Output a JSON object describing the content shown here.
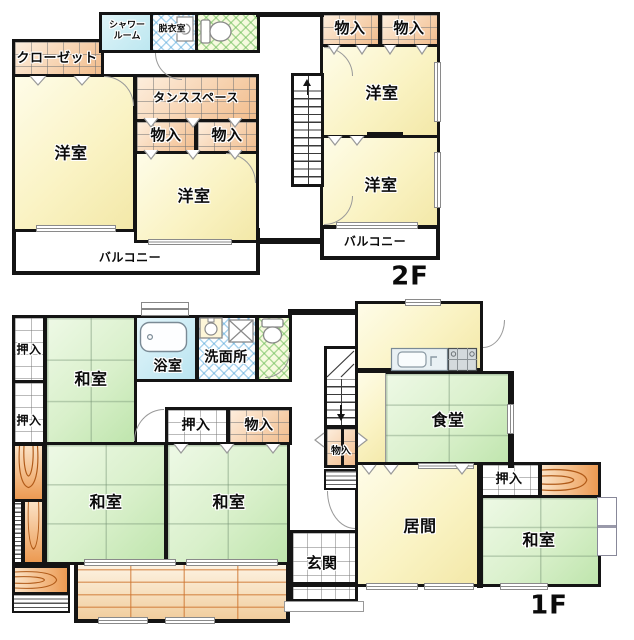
{
  "plan_type": "floor-plan",
  "colors": {
    "wall": "#141414",
    "western_room_fill": "#faf3c4",
    "tatami_fill": "#d9f0cb",
    "storage_fill": "#f2bd8d",
    "shower_fill": "#bde7f0",
    "bath_fill": "#b9e4f0",
    "veranda_fill": "#f1cd9d",
    "tokonoma_accent": "#ec9a52",
    "crosshatch_blue": "#46a0d7",
    "crosshatch_green": "#6ebe5a"
  },
  "f2": {
    "floor_label": "2F",
    "closet": "クローゼット",
    "shower_line1": "シャワー",
    "shower_line2": "ルーム",
    "dressing_room": "脱衣室",
    "tansu_space": "タンススペース",
    "storage_a": "物入",
    "storage_b": "物入",
    "storage_c": "物入",
    "storage_d": "物入",
    "western_room_left": "洋室",
    "western_room_middle": "洋室",
    "western_room_top_right": "洋室",
    "western_room_bottom_right": "洋室",
    "balcony_left": "バルコニー",
    "balcony_right": "バルコニー"
  },
  "f1": {
    "floor_label": "1F",
    "closet_a": "押入",
    "closet_b": "押入",
    "closet_mid": "押入",
    "storage_mid": "物入",
    "storage_under_stairs": "物入",
    "closet_right": "押入",
    "japanese_room_top_left": "和室",
    "japanese_room_bottom_left": "和室",
    "japanese_room_bottom_middle": "和室",
    "japanese_room_right": "和室",
    "bathroom": "浴室",
    "washroom": "洗面所",
    "dining_room": "食堂",
    "living_room": "居間",
    "entrance": "玄関"
  }
}
